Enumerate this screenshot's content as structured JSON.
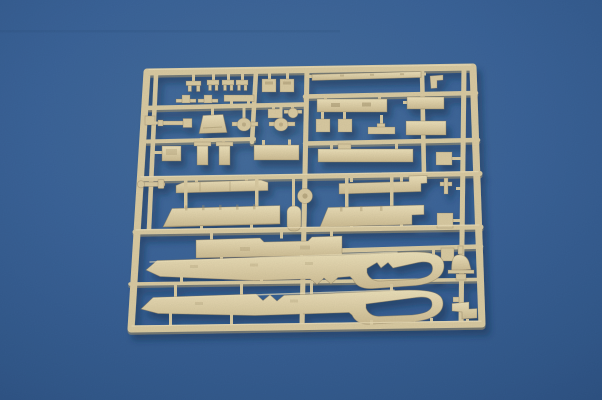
{
  "scene": {
    "type": "photograph",
    "subject": "Tan plastic model-kit sprue (injection-molded parts tree) lying on a blue backdrop",
    "details": {
      "frame": "rounded rectangular runner frame, slightly tilted",
      "top_half": "rows of small brackets, blocks, slotted plates and flat bars",
      "middle": "long flat skirt and deck strips with a round central molding hub",
      "bottom": "two large blade-shaped halves with oval cut-outs and notched teeth",
      "right_edge": "dome-shaped lamp part and stepped bracket"
    }
  },
  "colors": {
    "background_top": "#47709F",
    "background_mid": "#3C659B",
    "background_edge": "#2E5283",
    "plastic_base": "#DCCDA4",
    "plastic_light": "#EFE3BC",
    "plastic_shadow": "#A8976F",
    "plastic_outline": "#8A795A",
    "cast_shadow": "#12304F"
  }
}
